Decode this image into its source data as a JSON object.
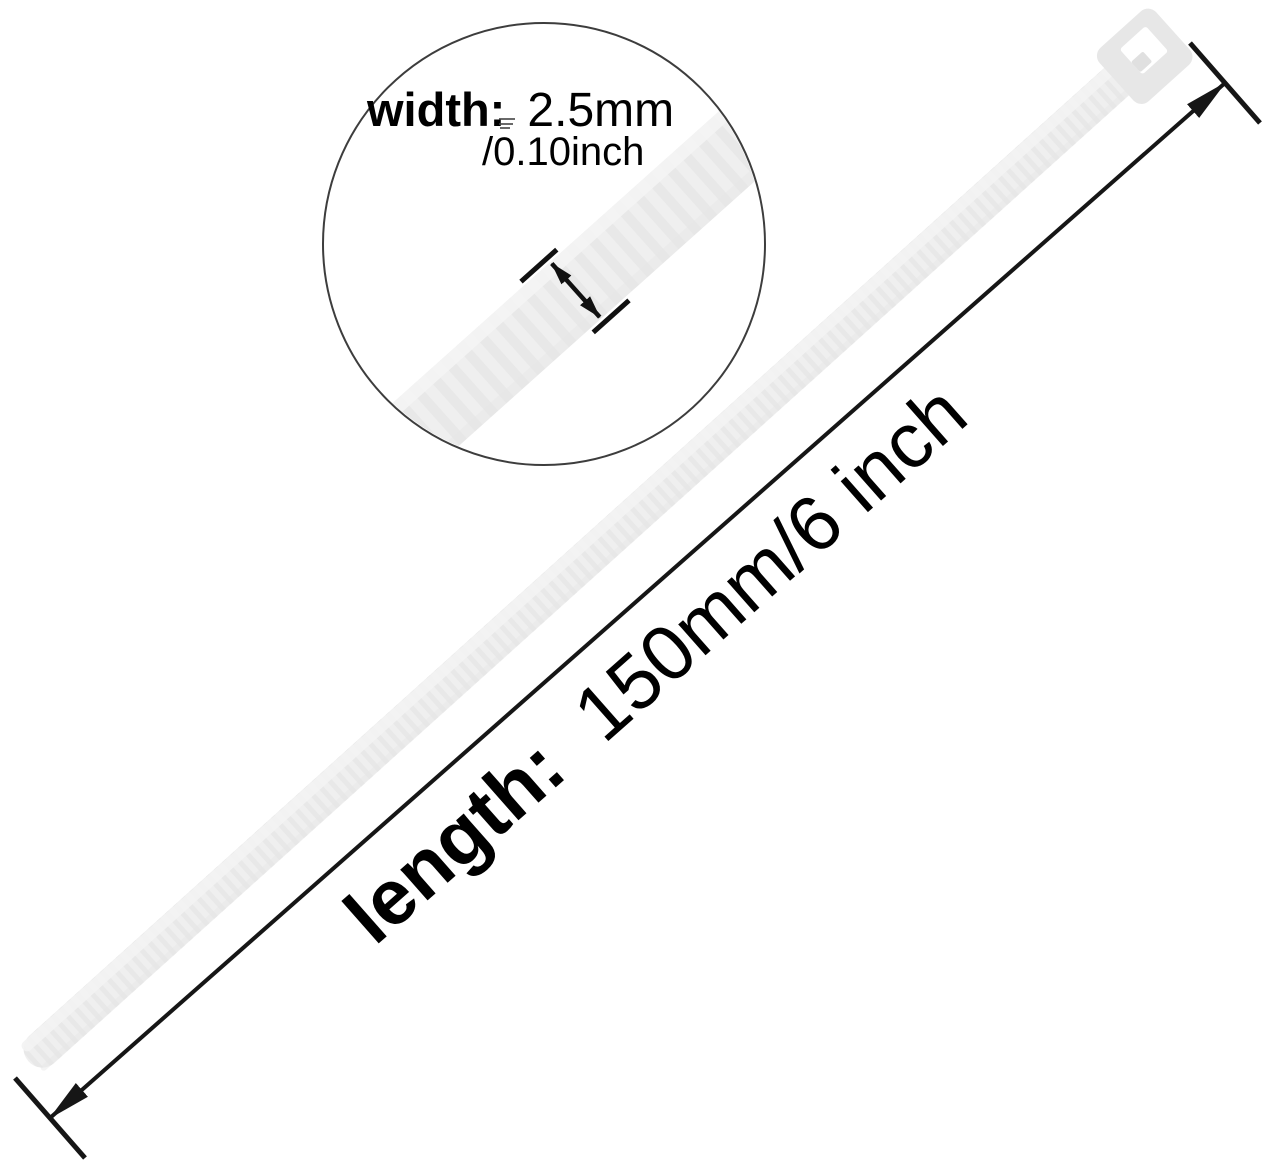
{
  "image": {
    "kind": "product-dimension-diagram",
    "subject": "nylon cable zip tie",
    "background": "#ffffff"
  },
  "product": {
    "name": "cable-tie",
    "body_color": "#efefef",
    "rib_color": "#e8e8e8",
    "rail_color": "#f3f3f3",
    "head_color": "#e7e7e7",
    "pawl_color": "#e0e0e0"
  },
  "magnifier": {
    "outline_color": "#3d3d3d",
    "fill": "#ffffff"
  },
  "dimensions": {
    "width": {
      "label": "width:",
      "value": "2.5mm",
      "alt_value": "/0.10inch"
    },
    "length": {
      "label": "length:",
      "value": "150mm/6 inch"
    }
  },
  "annotation": {
    "line_color": "#161616",
    "text_color": "#000000"
  }
}
